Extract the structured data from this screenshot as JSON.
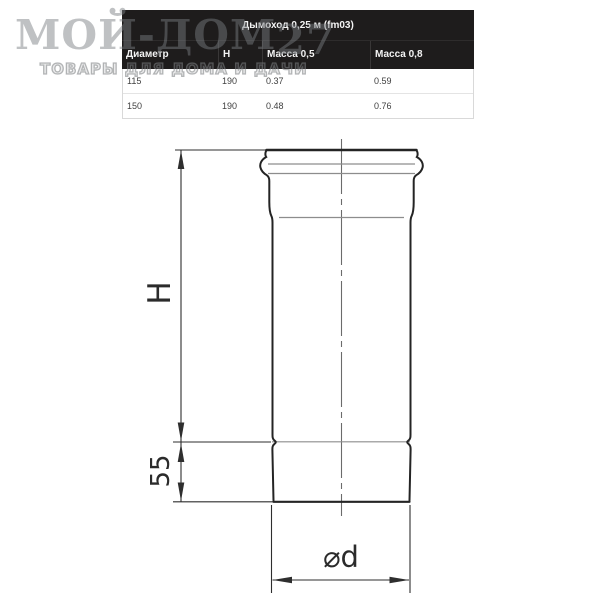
{
  "watermark": {
    "brand": "МОЙ-ДОМ",
    "brand_suffix": "27",
    "tagline": "ТОВАРЫ ДЛЯ ДОМА И ДАЧИ"
  },
  "table": {
    "title": "Дымоход 0,25 м (fm03)",
    "columns": [
      "Диаметр",
      "Н",
      "Масса 0,5",
      "Масса 0,8"
    ],
    "rows": [
      [
        "115",
        "190",
        "0.37",
        "0.59"
      ],
      [
        "150",
        "190",
        "0.48",
        "0.76"
      ]
    ]
  },
  "diagram": {
    "labels": {
      "height": "H",
      "lower_section": "55",
      "diameter": "⌀d"
    }
  },
  "colors": {
    "table_header_bg": "#1e1c1c",
    "table_header_text": "#f4f4f4",
    "table_row_text": "#404040",
    "drawing_line": "#2e2e2e",
    "drawing_secondary_line": "#8d8d8d",
    "watermark_gray": "#7a7e81"
  }
}
